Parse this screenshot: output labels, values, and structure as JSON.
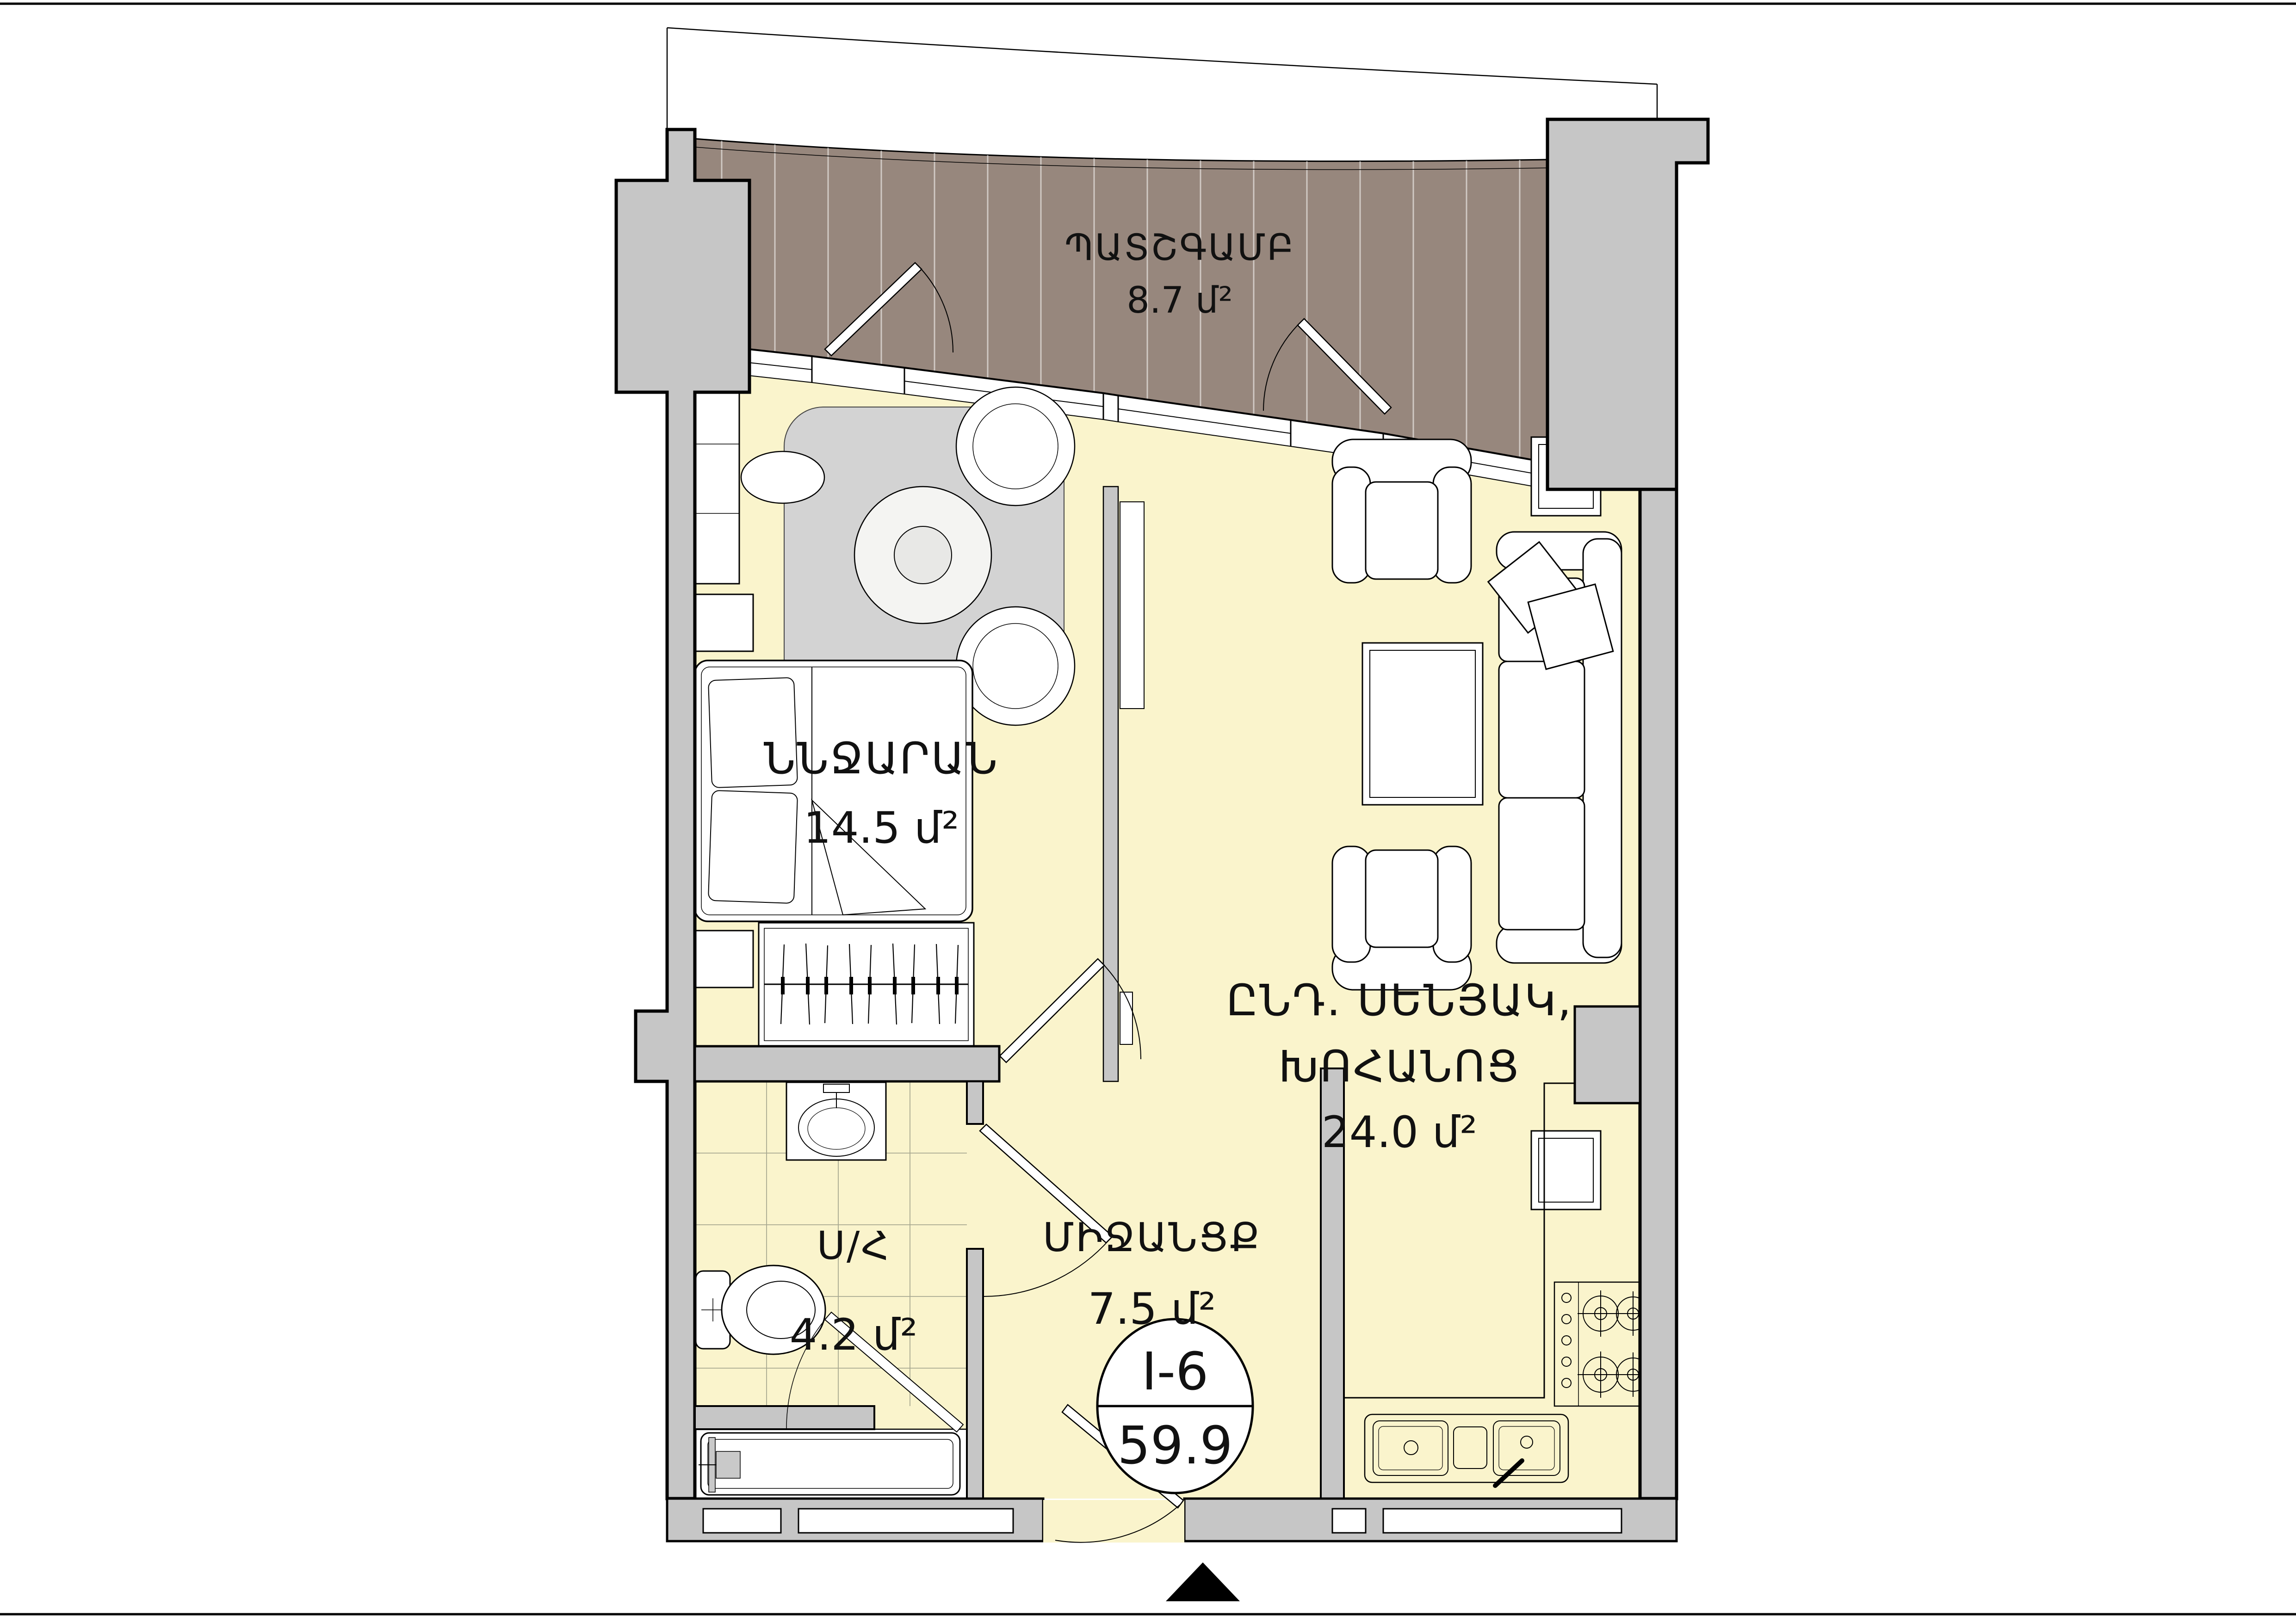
{
  "title": "Apartment unit floor plan",
  "rooms": {
    "balcony": {
      "name": "ՊԱՏՇԳԱՄԲ",
      "area": "8.7 մ²"
    },
    "bedroom": {
      "name": "ՆՆՋԱՐԱՆ",
      "area": "14.5 մ²"
    },
    "living_kitchen": {
      "name_line1": "ԸՆԴ. ՍԵՆՅԱԿ,",
      "name_line2": "ԽՈՀԱՆՈՑ",
      "area": "24.0 մ²"
    },
    "bathroom": {
      "name": "Ս/Հ",
      "area": "4.2 մ²"
    },
    "hallway": {
      "name": "ՄԻՋԱՆՑՔ",
      "area": "7.5 մ²"
    }
  },
  "unit_badge": {
    "unit": "I-6",
    "total_area": "59.9"
  },
  "icons": {
    "north_arrow": "entrance-direction-triangle"
  },
  "colors": {
    "floor": "#FAF4CC",
    "balcony_deck": "#97877D",
    "wall": "#C6C6C6",
    "rug": "#D3D3D3",
    "tile_line": "#A8A890",
    "outline": "#000000"
  }
}
